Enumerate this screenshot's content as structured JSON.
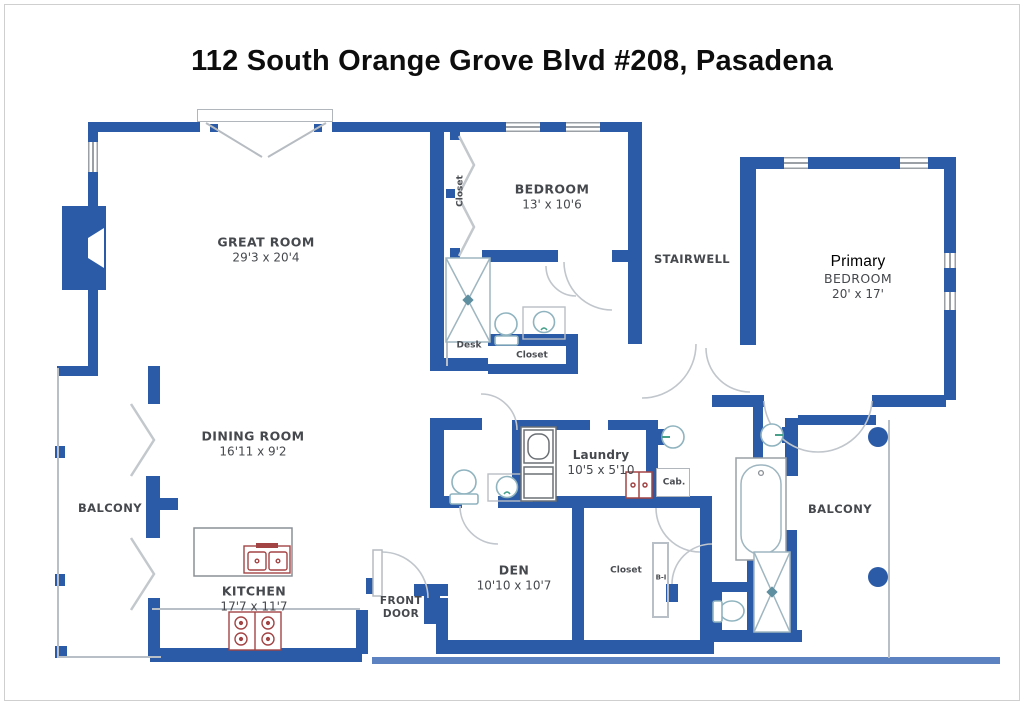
{
  "title": "112 South Orange Grove Blvd #208, Pasadena",
  "colors": {
    "wall_blue": "#2b5ba6",
    "terrace_blue": "#5d82c2",
    "fixture_teal": "#8fb3bf",
    "appliance_red": "#a34444",
    "line_gray": "#b9bfc6",
    "label_gray": "#45484d"
  },
  "rooms": {
    "great_room": {
      "name": "GREAT ROOM",
      "dims": "29'3 x 20'4"
    },
    "bedroom": {
      "name": "BEDROOM",
      "dims": "13' x 10'6"
    },
    "primary_bedroom": {
      "prefix": "Primary",
      "name": "BEDROOM",
      "dims": "20' x 17'"
    },
    "stairwell": {
      "name": "STAIRWELL"
    },
    "dining_room": {
      "name": "DINING ROOM",
      "dims": "16'11 x 9'2"
    },
    "kitchen": {
      "name": "KITCHEN",
      "dims": "17'7 x 11'7"
    },
    "den": {
      "name": "DEN",
      "dims": "10'10 x 10'7"
    },
    "laundry": {
      "name": "Laundry",
      "dims": "10'5 x 5'10"
    },
    "balcony_left": {
      "name": "BALCONY"
    },
    "balcony_right": {
      "name": "BALCONY"
    },
    "front_door": {
      "name": "FRONT DOOR"
    }
  },
  "annotations": {
    "closet_bedroom": "Closet",
    "closet_hall": "Closet",
    "closet_den": "Closet",
    "desk": "Desk",
    "cab": "Cab.",
    "built_in": "B-I"
  }
}
